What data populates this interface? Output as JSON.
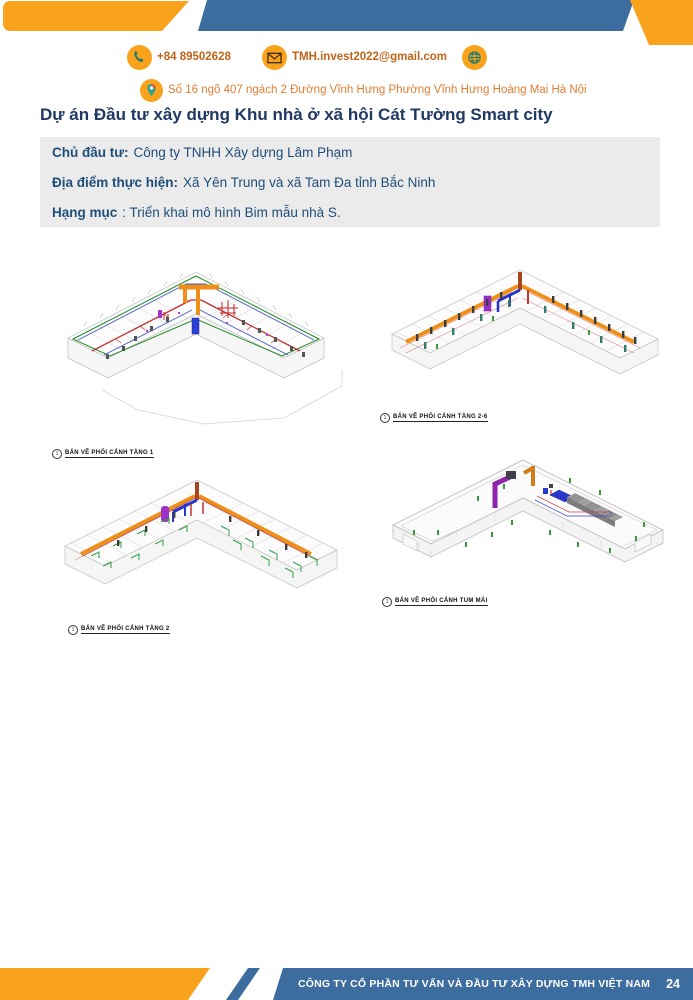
{
  "header": {
    "contact": {
      "phone": "+84 89502628",
      "email": "TMH.invest2022@gmail.com",
      "address": "Số 16 ngõ 407 ngách 2 Đường Vĩnh Hưng Phường Vĩnh Hưng Hoàng Mai Hà Nội"
    },
    "colors": {
      "banner_orange": "#F9A21B",
      "banner_blue": "#3D6C9E"
    }
  },
  "title": "Dự án Đầu tư xây dựng Khu nhà ở xã hội Cát Tường Smart city",
  "project_info": {
    "rows": [
      {
        "label": "Chủ đầu tư:",
        "value": "Công ty TNHH Xây dựng Lâm Phạm"
      },
      {
        "label": "Địa điểm thực hiện:",
        "value": "Xã Yên Trung và xã Tam Đa tỉnh Bắc Ninh"
      },
      {
        "label": "Hạng mục",
        "value": ": Triển khai mô hình Bim mẫu nhà S."
      }
    ]
  },
  "figures": [
    {
      "ref": "1",
      "caption": "BẢN VẼ PHỐI CẢNH TẦNG 1"
    },
    {
      "ref": "1",
      "caption": "BẢN VẼ PHỐI CẢNH TẦNG 2-6"
    },
    {
      "ref": "1",
      "caption": "BẢN VẼ PHỐI CẢNH TẦNG 2"
    },
    {
      "ref": "1",
      "caption": "BẢN VẼ PHỐI CẢNH TUM MÁI"
    }
  ],
  "footer": {
    "company": "CÔNG TY CỔ PHẦN TƯ VẤN VÀ ĐẦU TƯ XÂY DỰNG TMH VIỆT NAM",
    "page": "24"
  }
}
